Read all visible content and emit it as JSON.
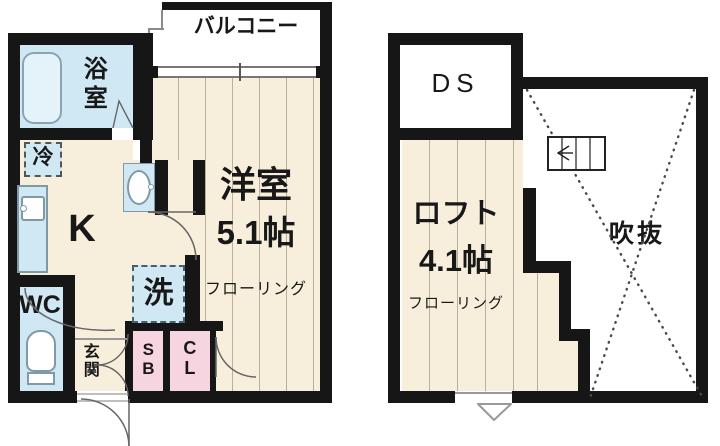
{
  "title": "apartment-floorplan",
  "colors": {
    "wall": "#161616",
    "flooring_cream": "#f7efdb",
    "water_blue": "#cfe8f4",
    "closet_pink": "#f6d5e0",
    "bathtub_blue": "#e4f2f9",
    "floor_line_gray": "#b9b19b",
    "annotation_gray": "#666666"
  },
  "floor1": {
    "balcony": "バルコニー",
    "bathroom": "浴室",
    "fridge": "冷",
    "kitchen": "K",
    "toilet": "WC",
    "entrance": "玄関",
    "washer": "洗",
    "shoe_box": "SB",
    "closet": "CL",
    "room_name": "洋室",
    "room_size": "5.1帖",
    "room_finish": "フローリング"
  },
  "floor2": {
    "duct_space": "DS",
    "loft_name": "ロフト",
    "loft_size": "4.1帖",
    "loft_finish": "フローリング",
    "void": "吹抜"
  }
}
